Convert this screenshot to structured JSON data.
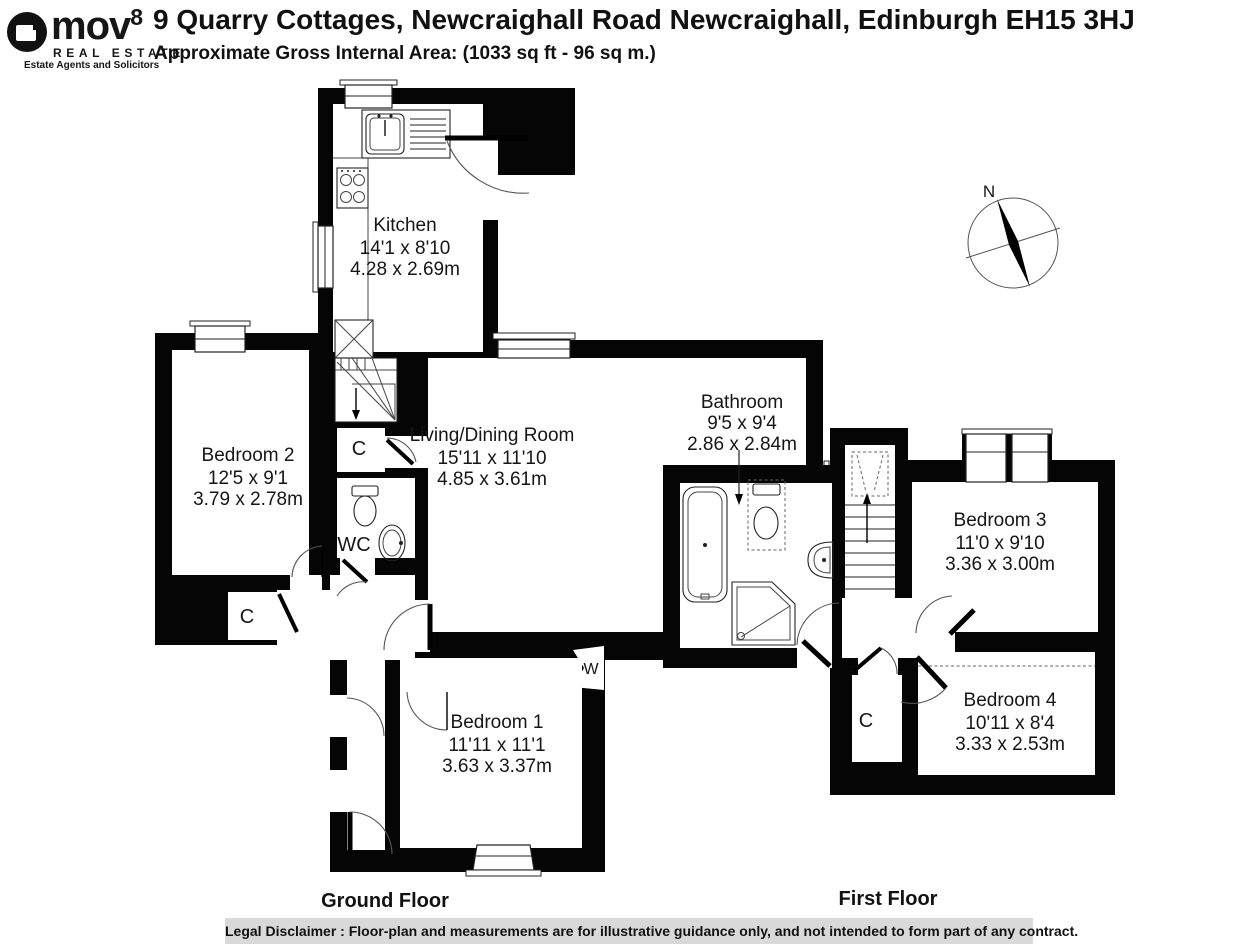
{
  "header": {
    "logo": {
      "word": "mov",
      "sup": "8",
      "realestate": "REAL ESTATE",
      "tagline": "Estate Agents and Solicitors"
    },
    "title": "9 Quarry Cottages, Newcraighall Road Newcraighall, Edinburgh EH15 3HJ",
    "subtitle": "Approximate Gross Internal Area: (1033 sq ft - 96 sq m.)"
  },
  "floors": [
    {
      "title": "Ground Floor",
      "rooms": [
        {
          "name": "Kitchen",
          "imperial": "14'1 x 8'10",
          "metric": "4.28 x 2.69m"
        },
        {
          "name": "Living/Dining Room",
          "imperial": "15'11 x 11'10",
          "metric": "4.85 x 3.61m"
        },
        {
          "name": "Bedroom 2",
          "imperial": "12'5 x 9'1",
          "metric": "3.79 x 2.78m"
        },
        {
          "name": "Bedroom 1",
          "imperial": "11'11 x 11'1",
          "metric": "3.63 x 3.37m"
        }
      ],
      "small_labels": {
        "wc": "WC",
        "closet1": "C",
        "closet2": "C",
        "wardrobe": "W"
      }
    },
    {
      "title": "First Floor",
      "rooms": [
        {
          "name": "Bathroom",
          "imperial": "9'5 x 9'4",
          "metric": "2.86 x 2.84m"
        },
        {
          "name": "Bedroom 3",
          "imperial": "11'0 x 9'10",
          "metric": "3.36 x 3.00m"
        },
        {
          "name": "Bedroom 4",
          "imperial": "10'11 x 8'4",
          "metric": "3.33 x 2.53m"
        }
      ],
      "small_labels": {
        "closet": "C"
      }
    }
  ],
  "compass": {
    "north": "N"
  },
  "footer": {
    "disclaimer": "Legal Disclaimer : Floor-plan and measurements are for illustrative guidance only, and not intended to form part of any contract."
  },
  "colors": {
    "wall": "#050505",
    "disclaimer_bg": "#d9d9d9",
    "text": "#161616"
  }
}
